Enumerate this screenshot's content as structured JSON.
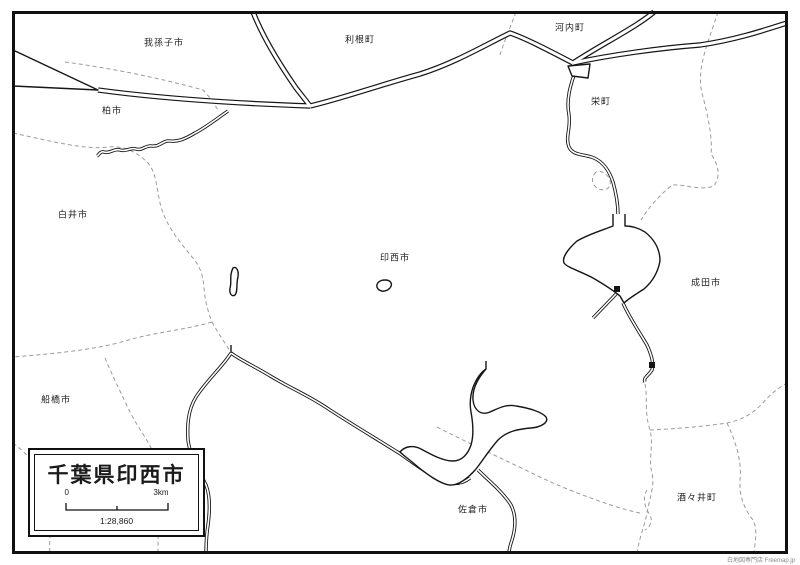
{
  "title_box": {
    "title": "千葉県印西市",
    "scale_zero": "0",
    "scale_max": "3km",
    "scale_ratio": "1:28,860"
  },
  "map_labels": [
    "我孫子市",
    "利根町",
    "河内町",
    "柏市",
    "栄町",
    "白井市",
    "印西市",
    "成田市",
    "船橋市",
    "佐倉市",
    "酒々井町"
  ],
  "credit": "白地図専門店 Freemap.jp",
  "colors": {
    "ink": "#161616",
    "frame": "#111111",
    "boundary_dash": "#9b9b9b",
    "background": "#ffffff"
  }
}
